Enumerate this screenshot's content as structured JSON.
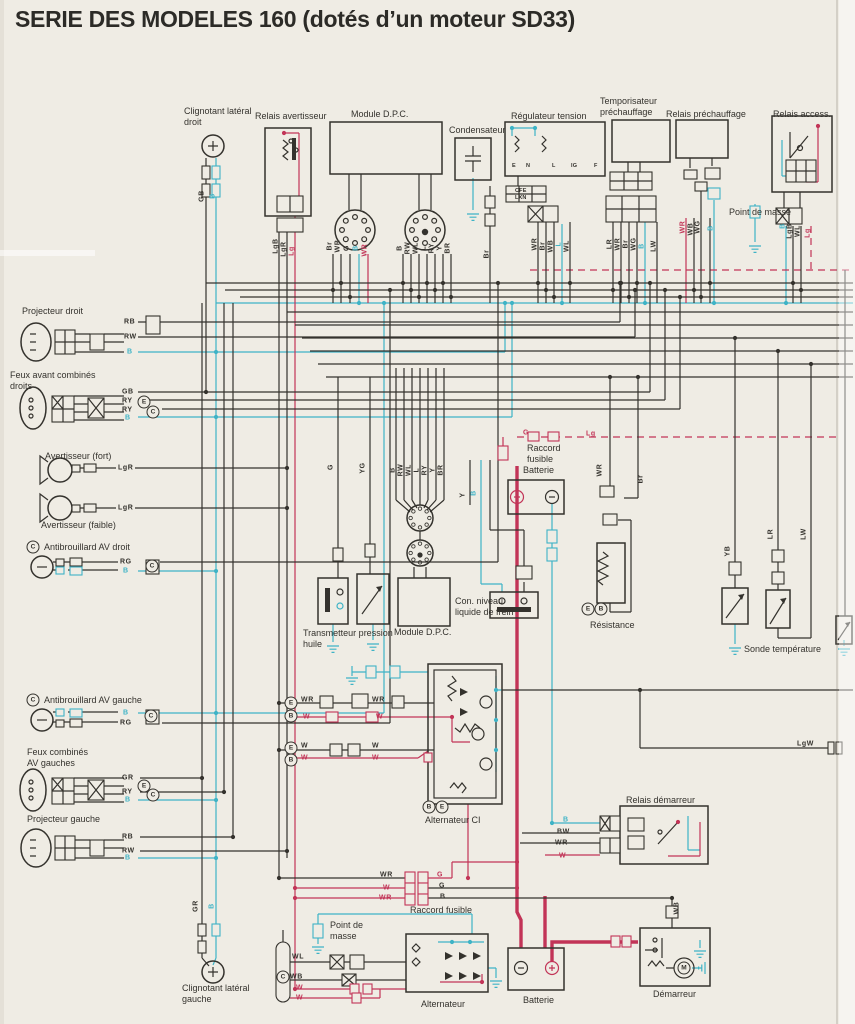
{
  "title": "SERIE DES MODELES 160 (dotés d’un moteur SD33)",
  "colors": {
    "paper": "#efece4",
    "ink": "#34322d",
    "cyan": "#3eb3c6",
    "red": "#c23457"
  },
  "component_labels": [
    {
      "id": "clignotant-lateral-droit",
      "text": "Clignotant latéral\ndroit",
      "x": 184,
      "y": 106
    },
    {
      "id": "relais-avertisseur",
      "text": "Relais avertisseur",
      "x": 255,
      "y": 111
    },
    {
      "id": "module-dpc-1",
      "text": "Module D.P.C.",
      "x": 351,
      "y": 109
    },
    {
      "id": "condensateur",
      "text": "Condensateur",
      "x": 449,
      "y": 125
    },
    {
      "id": "regulateur-tension",
      "text": "Régulateur tension",
      "x": 511,
      "y": 111
    },
    {
      "id": "temporisateur-prechauffage",
      "text": "Temporisateur\npréchauffage",
      "x": 600,
      "y": 96
    },
    {
      "id": "relais-prechauffage",
      "text": "Relais préchauffage",
      "x": 666,
      "y": 109
    },
    {
      "id": "relais-access",
      "text": "Relais access.",
      "x": 773,
      "y": 109
    },
    {
      "id": "point-de-masse-1",
      "text": "Point de masse",
      "x": 729,
      "y": 207
    },
    {
      "id": "projecteur-droit",
      "text": "Projecteur droit",
      "x": 22,
      "y": 306
    },
    {
      "id": "feux-avant-combines-droits",
      "text": "Feux avant combinés\ndroits",
      "x": 10,
      "y": 370
    },
    {
      "id": "avertisseur-fort",
      "text": "Avertisseur (fort)",
      "x": 45,
      "y": 451
    },
    {
      "id": "avertisseur-faible",
      "text": "Avertisseur (faible)",
      "x": 41,
      "y": 520
    },
    {
      "id": "antibrouillard-av-droit",
      "text": "Antibrouillard AV droit",
      "x": 44,
      "y": 542
    },
    {
      "id": "antibrouillard-av-gauche",
      "text": "Antibrouillard AV gauche",
      "x": 44,
      "y": 695
    },
    {
      "id": "feux-combines-av-gauches",
      "text": "Feux combinés\nAV gauches",
      "x": 27,
      "y": 747
    },
    {
      "id": "projecteur-gauche",
      "text": "Projecteur gauche",
      "x": 27,
      "y": 814
    },
    {
      "id": "clignotant-lateral-gauche",
      "text": "Clignotant latéral\ngauche",
      "x": 182,
      "y": 983
    },
    {
      "id": "raccord-fusible-1",
      "text": "Raccord\nfusible",
      "x": 527,
      "y": 443
    },
    {
      "id": "batterie-1",
      "text": "Batterie",
      "x": 523,
      "y": 465
    },
    {
      "id": "transmetteur-pression-huile",
      "text": "Transmetteur pression\nhuile",
      "x": 303,
      "y": 628
    },
    {
      "id": "module-dpc-2",
      "text": "Module D.P.C.",
      "x": 394,
      "y": 627
    },
    {
      "id": "con-niveau-liquide-frein",
      "text": "Con. niveau\nliquide de frein",
      "x": 455,
      "y": 596
    },
    {
      "id": "resistance",
      "text": "Résistance",
      "x": 590,
      "y": 620
    },
    {
      "id": "sonde-temperature",
      "text": "Sonde température",
      "x": 744,
      "y": 644
    },
    {
      "id": "alternateur-ci",
      "text": "Alternateur CI",
      "x": 425,
      "y": 815
    },
    {
      "id": "relais-demarreur",
      "text": "Relais démarreur",
      "x": 626,
      "y": 795
    },
    {
      "id": "raccord-fusible-2",
      "text": "Raccord fusible",
      "x": 410,
      "y": 905
    },
    {
      "id": "point-de-masse-2",
      "text": "Point de\nmasse",
      "x": 330,
      "y": 920
    },
    {
      "id": "alternateur-2",
      "text": "Alternateur",
      "x": 421,
      "y": 999
    },
    {
      "id": "batterie-2",
      "text": "Batterie",
      "x": 523,
      "y": 995
    },
    {
      "id": "demarreur",
      "text": "Démarreur",
      "x": 653,
      "y": 989
    }
  ],
  "wire_labels": [
    {
      "t": "RB",
      "x": 124,
      "y": 322
    },
    {
      "t": "RW",
      "x": 124,
      "y": 337
    },
    {
      "t": "B",
      "x": 127,
      "y": 352,
      "c": "c"
    },
    {
      "t": "GB",
      "x": 122,
      "y": 392
    },
    {
      "t": "RY",
      "x": 122,
      "y": 401
    },
    {
      "t": "RY",
      "x": 122,
      "y": 410
    },
    {
      "t": "B",
      "x": 125,
      "y": 418,
      "c": "c"
    },
    {
      "t": "LgR",
      "x": 118,
      "y": 468
    },
    {
      "t": "LgR",
      "x": 118,
      "y": 508
    },
    {
      "t": "RG",
      "x": 120,
      "y": 562
    },
    {
      "t": "B",
      "x": 123,
      "y": 571,
      "c": "c"
    },
    {
      "t": "B",
      "x": 123,
      "y": 713,
      "c": "c"
    },
    {
      "t": "RG",
      "x": 120,
      "y": 723
    },
    {
      "t": "GR",
      "x": 122,
      "y": 778
    },
    {
      "t": "RY",
      "x": 122,
      "y": 792
    },
    {
      "t": "B",
      "x": 125,
      "y": 800,
      "c": "c"
    },
    {
      "t": "RB",
      "x": 122,
      "y": 837
    },
    {
      "t": "RW",
      "x": 122,
      "y": 851
    },
    {
      "t": "B",
      "x": 125,
      "y": 858,
      "c": "c"
    },
    {
      "t": "WR",
      "x": 301,
      "y": 700
    },
    {
      "t": "W",
      "x": 303,
      "y": 717,
      "c": "r"
    },
    {
      "t": "WR",
      "x": 372,
      "y": 700
    },
    {
      "t": "W",
      "x": 376,
      "y": 717,
      "c": "r"
    },
    {
      "t": "W",
      "x": 301,
      "y": 746
    },
    {
      "t": "W",
      "x": 301,
      "y": 758,
      "c": "r"
    },
    {
      "t": "W",
      "x": 372,
      "y": 746
    },
    {
      "t": "W",
      "x": 372,
      "y": 758,
      "c": "r"
    },
    {
      "t": "B",
      "x": 563,
      "y": 820,
      "c": "c"
    },
    {
      "t": "BW",
      "x": 557,
      "y": 832
    },
    {
      "t": "WR",
      "x": 555,
      "y": 843
    },
    {
      "t": "W",
      "x": 559,
      "y": 856,
      "c": "r"
    },
    {
      "t": "WR",
      "x": 380,
      "y": 875
    },
    {
      "t": "W",
      "x": 383,
      "y": 888,
      "c": "r"
    },
    {
      "t": "WR",
      "x": 379,
      "y": 898,
      "c": "r"
    },
    {
      "t": "G",
      "x": 437,
      "y": 875,
      "c": "r"
    },
    {
      "t": "G",
      "x": 439,
      "y": 886
    },
    {
      "t": "B",
      "x": 440,
      "y": 897
    },
    {
      "t": "G",
      "x": 523,
      "y": 433,
      "c": "r"
    },
    {
      "t": "Lg",
      "x": 586,
      "y": 434,
      "c": "r"
    },
    {
      "t": "LgW",
      "x": 797,
      "y": 744
    },
    {
      "t": "WL",
      "x": 292,
      "y": 957
    },
    {
      "t": "WB",
      "x": 290,
      "y": 977
    },
    {
      "t": "W",
      "x": 296,
      "y": 988,
      "c": "r"
    },
    {
      "t": "W",
      "x": 296,
      "y": 998,
      "c": "r"
    },
    {
      "t": "E",
      "x": 512,
      "y": 166,
      "s": 1
    },
    {
      "t": "N",
      "x": 526,
      "y": 166,
      "s": 1
    },
    {
      "t": "L",
      "x": 552,
      "y": 166,
      "s": 1
    },
    {
      "t": "IG",
      "x": 571,
      "y": 166,
      "s": 1
    },
    {
      "t": "F",
      "x": 594,
      "y": 166,
      "s": 1
    },
    {
      "t": "CFE",
      "x": 515,
      "y": 191,
      "s": 1
    },
    {
      "t": "LXN",
      "x": 515,
      "y": 198,
      "s": 1
    },
    {
      "t": "GB",
      "x": 202,
      "y": 196,
      "v": 1
    },
    {
      "t": "B",
      "x": 213,
      "y": 196,
      "v": 1,
      "c": "c"
    },
    {
      "t": "LgB",
      "x": 276,
      "y": 246,
      "v": 1
    },
    {
      "t": "LgR",
      "x": 284,
      "y": 249,
      "v": 1
    },
    {
      "t": "Lg",
      "x": 292,
      "y": 251,
      "v": 1,
      "c": "r"
    },
    {
      "t": "Br",
      "x": 330,
      "y": 246,
      "v": 1
    },
    {
      "t": "WR",
      "x": 338,
      "y": 246,
      "v": 1
    },
    {
      "t": "G",
      "x": 347,
      "y": 248,
      "v": 1
    },
    {
      "t": "B",
      "x": 356,
      "y": 248,
      "v": 1,
      "c": "c"
    },
    {
      "t": "WR",
      "x": 365,
      "y": 250,
      "v": 1,
      "c": "r"
    },
    {
      "t": "B",
      "x": 400,
      "y": 248,
      "v": 1
    },
    {
      "t": "RW",
      "x": 408,
      "y": 248,
      "v": 1
    },
    {
      "t": "WL",
      "x": 416,
      "y": 248,
      "v": 1
    },
    {
      "t": "L",
      "x": 424,
      "y": 248,
      "v": 1
    },
    {
      "t": "RY",
      "x": 432,
      "y": 248,
      "v": 1
    },
    {
      "t": "Y",
      "x": 440,
      "y": 248,
      "v": 1
    },
    {
      "t": "BR",
      "x": 448,
      "y": 248,
      "v": 1
    },
    {
      "t": "Br",
      "x": 487,
      "y": 254,
      "v": 1
    },
    {
      "t": "WR",
      "x": 535,
      "y": 244,
      "v": 1
    },
    {
      "t": "Br",
      "x": 543,
      "y": 246,
      "v": 1
    },
    {
      "t": "WB",
      "x": 551,
      "y": 246,
      "v": 1
    },
    {
      "t": "L",
      "x": 559,
      "y": 244,
      "v": 1,
      "c": "c"
    },
    {
      "t": "WL",
      "x": 567,
      "y": 246,
      "v": 1
    },
    {
      "t": "LR",
      "x": 610,
      "y": 244,
      "v": 1
    },
    {
      "t": "WR",
      "x": 618,
      "y": 244,
      "v": 1
    },
    {
      "t": "Br",
      "x": 626,
      "y": 244,
      "v": 1
    },
    {
      "t": "WG",
      "x": 634,
      "y": 244,
      "v": 1
    },
    {
      "t": "B",
      "x": 642,
      "y": 246,
      "v": 1,
      "c": "c"
    },
    {
      "t": "LW",
      "x": 654,
      "y": 246,
      "v": 1
    },
    {
      "t": "WR",
      "x": 683,
      "y": 227,
      "v": 1,
      "c": "r"
    },
    {
      "t": "WB",
      "x": 691,
      "y": 229,
      "v": 1
    },
    {
      "t": "WG",
      "x": 698,
      "y": 227,
      "v": 1
    },
    {
      "t": "B",
      "x": 711,
      "y": 228,
      "v": 1,
      "c": "c"
    },
    {
      "t": "B",
      "x": 783,
      "y": 226,
      "v": 1,
      "c": "c"
    },
    {
      "t": "LgB",
      "x": 790,
      "y": 231,
      "v": 1
    },
    {
      "t": "WL",
      "x": 798,
      "y": 231,
      "v": 1
    },
    {
      "t": "Lg",
      "x": 808,
      "y": 233,
      "v": 1,
      "c": "r"
    },
    {
      "t": "G",
      "x": 331,
      "y": 467,
      "v": 1
    },
    {
      "t": "YG",
      "x": 363,
      "y": 468,
      "v": 1
    },
    {
      "t": "B",
      "x": 393,
      "y": 470,
      "v": 1
    },
    {
      "t": "RW",
      "x": 401,
      "y": 470,
      "v": 1
    },
    {
      "t": "WL",
      "x": 409,
      "y": 470,
      "v": 1
    },
    {
      "t": "L",
      "x": 417,
      "y": 470,
      "v": 1
    },
    {
      "t": "RY",
      "x": 425,
      "y": 470,
      "v": 1
    },
    {
      "t": "Y",
      "x": 433,
      "y": 470,
      "v": 1
    },
    {
      "t": "BR",
      "x": 441,
      "y": 470,
      "v": 1
    },
    {
      "t": "Y",
      "x": 463,
      "y": 495,
      "v": 1
    },
    {
      "t": "B",
      "x": 474,
      "y": 493,
      "v": 1,
      "c": "c"
    },
    {
      "t": "WR",
      "x": 600,
      "y": 470,
      "v": 1
    },
    {
      "t": "Br",
      "x": 641,
      "y": 479,
      "v": 1
    },
    {
      "t": "YB",
      "x": 728,
      "y": 551,
      "v": 1
    },
    {
      "t": "LR",
      "x": 771,
      "y": 534,
      "v": 1
    },
    {
      "t": "LW",
      "x": 804,
      "y": 534,
      "v": 1
    },
    {
      "t": "GR",
      "x": 196,
      "y": 906,
      "v": 1
    },
    {
      "t": "B",
      "x": 212,
      "y": 906,
      "v": 1,
      "c": "c"
    },
    {
      "t": "WB",
      "x": 677,
      "y": 908,
      "v": 1
    }
  ],
  "circled_letters": [
    {
      "t": "C",
      "x": 33,
      "y": 547
    },
    {
      "t": "C",
      "x": 33,
      "y": 700
    },
    {
      "t": "E",
      "x": 144,
      "y": 402
    },
    {
      "t": "C",
      "x": 153,
      "y": 412
    },
    {
      "t": "C",
      "x": 152,
      "y": 566
    },
    {
      "t": "C",
      "x": 151,
      "y": 716
    },
    {
      "t": "E",
      "x": 144,
      "y": 786
    },
    {
      "t": "C",
      "x": 153,
      "y": 795
    },
    {
      "t": "E",
      "x": 291,
      "y": 703
    },
    {
      "t": "B",
      "x": 291,
      "y": 716
    },
    {
      "t": "E",
      "x": 291,
      "y": 748
    },
    {
      "t": "B",
      "x": 291,
      "y": 760
    },
    {
      "t": "B",
      "x": 429,
      "y": 807
    },
    {
      "t": "E",
      "x": 442,
      "y": 807
    },
    {
      "t": "E",
      "x": 588,
      "y": 609
    },
    {
      "t": "B",
      "x": 601,
      "y": 609
    },
    {
      "t": "C",
      "x": 283,
      "y": 977
    },
    {
      "t": "M",
      "x": 684,
      "y": 968
    }
  ]
}
